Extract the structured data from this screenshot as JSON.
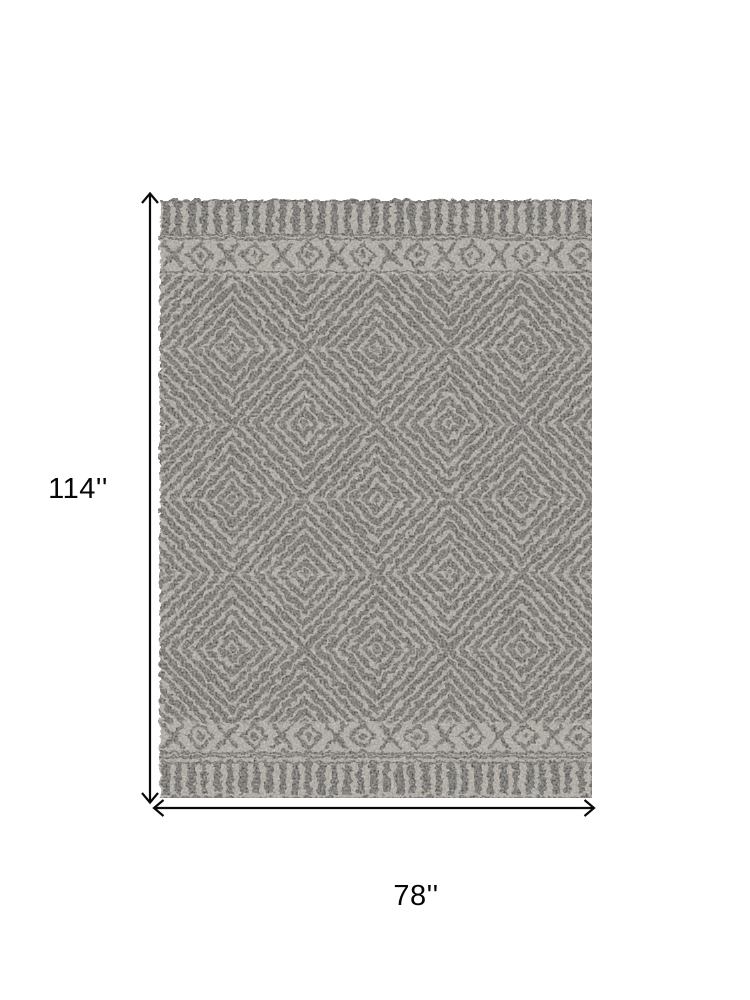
{
  "page": {
    "background": "#ffffff"
  },
  "annotation": {
    "height_label": "114''",
    "width_label": "78''",
    "arrow_color": "#0a0a0a"
  },
  "rug": {
    "description": "Distressed gray area rug with tribal concentric diamond lattice field, diamond-and-cross motif bands, and dashed stripe end borders",
    "colors": {
      "base": "#afa9a1",
      "pattern_dark": "#3e3a36",
      "border_dark": "#33302c",
      "seam_light": "#c9c3bb"
    }
  }
}
